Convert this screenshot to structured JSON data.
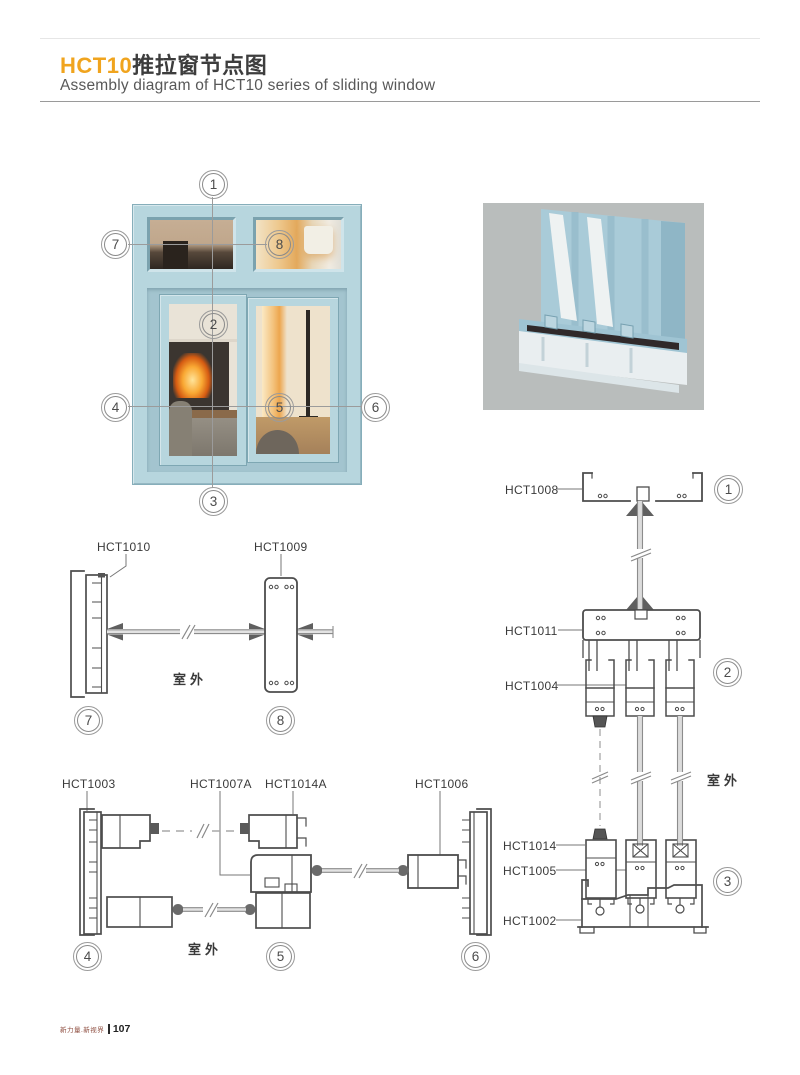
{
  "header": {
    "title_code": "HCT10",
    "title_cn": "推拉窗节点图",
    "subtitle": "Assembly diagram of HCT10 series of sliding window",
    "accent_color": "#F0A41E"
  },
  "window_callouts": [
    {
      "n": "1"
    },
    {
      "n": "2"
    },
    {
      "n": "3"
    },
    {
      "n": "4"
    },
    {
      "n": "5"
    },
    {
      "n": "6"
    },
    {
      "n": "7"
    },
    {
      "n": "8"
    }
  ],
  "detail_78": {
    "labels": [
      {
        "text": "HCT1010"
      },
      {
        "text": "HCT1009"
      }
    ],
    "outdoor": "室外",
    "callouts": [
      {
        "n": "7"
      },
      {
        "n": "8"
      }
    ]
  },
  "detail_456": {
    "labels": [
      {
        "text": "HCT1003"
      },
      {
        "text": "HCT1007A"
      },
      {
        "text": "HCT1014A"
      },
      {
        "text": "HCT1006"
      }
    ],
    "outdoor": "室外",
    "callouts": [
      {
        "n": "4"
      },
      {
        "n": "5"
      },
      {
        "n": "6"
      }
    ]
  },
  "detail_123": {
    "labels": [
      {
        "text": "HCT1008"
      },
      {
        "text": "HCT1011"
      },
      {
        "text": "HCT1004"
      },
      {
        "text": "HCT1014"
      },
      {
        "text": "HCT1005"
      },
      {
        "text": "HCT1002"
      }
    ],
    "outdoor": "室外",
    "callouts": [
      {
        "n": "1"
      },
      {
        "n": "2"
      },
      {
        "n": "3"
      }
    ]
  },
  "colors": {
    "frame_blue": "#B7D6DE",
    "render_background": "#B9BDBC",
    "drawing_line": "#4D4D4D"
  },
  "footer": {
    "brand": "新力量.新视界",
    "page_number": "107"
  }
}
